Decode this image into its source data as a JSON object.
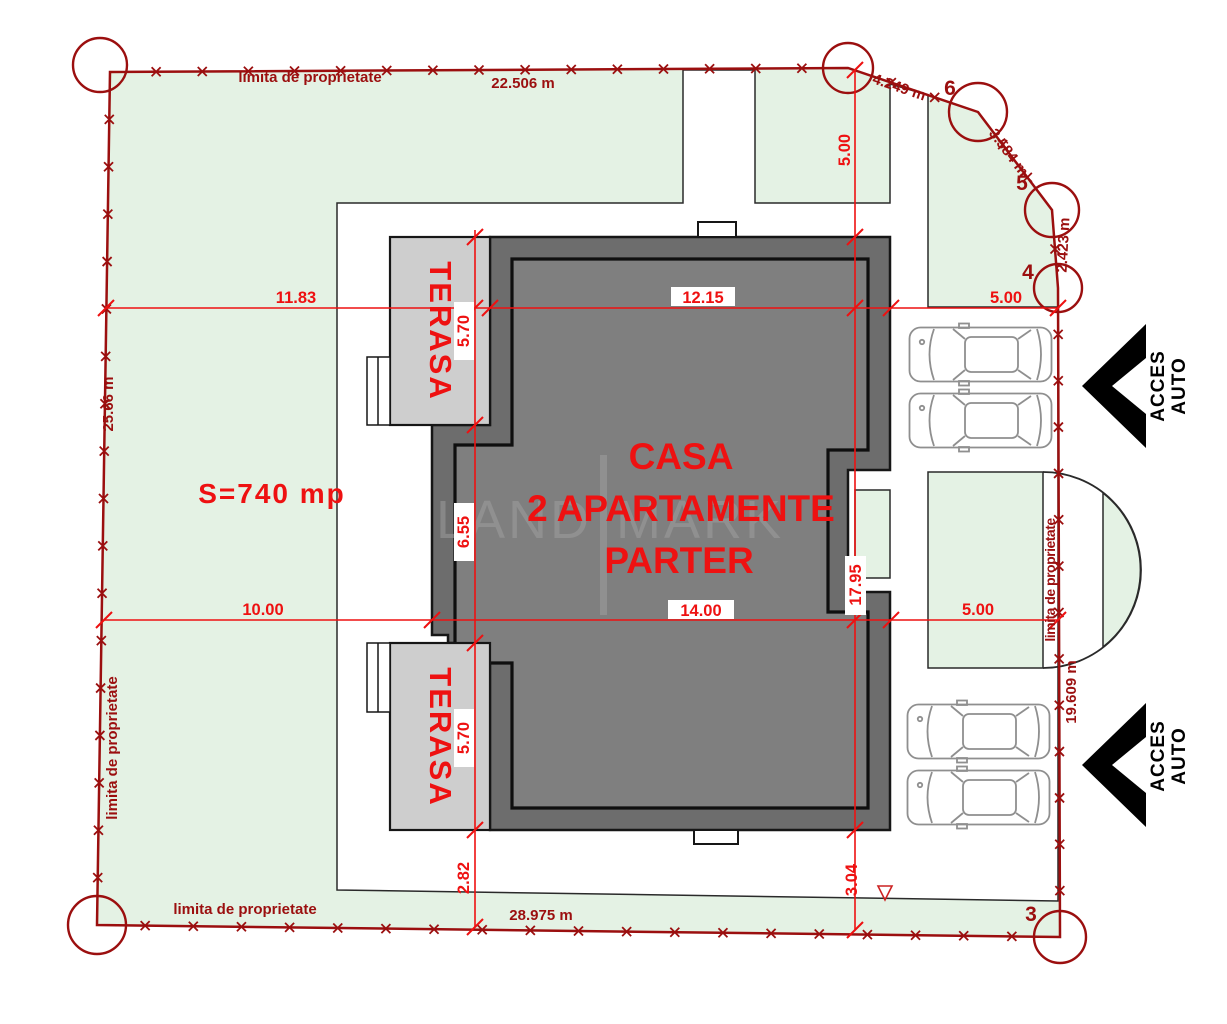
{
  "watermark": {
    "left": "LAND",
    "right": "MARK"
  },
  "area_label": "S=740 mp",
  "building_label": {
    "line1": "CASA",
    "line2": "2 APARTAMENTE",
    "line3": "PARTER"
  },
  "terraces": {
    "top": "TERASA",
    "bottom": "TERASA"
  },
  "boundary": {
    "label_top": "limita  de proprietate",
    "label_left": "limita de proprietate",
    "label_bottom": "limita de proprietate",
    "label_right": "limita de proprietate",
    "len_top": "22.506 m",
    "len_left": "25.66 m",
    "len_bottom": "28.975 m",
    "len_right": "19.609 m",
    "len_ne1": "4.249 m",
    "len_ne2": "3.584 m",
    "len_ne3": "2.423 m",
    "points": {
      "p3": "3",
      "p4": "4",
      "p5": "5",
      "p6": "6"
    }
  },
  "dimensions": {
    "w_left": "11.83",
    "w_mid": "12.15",
    "w_right": "5.00",
    "setback_top": "5.00",
    "terrace_top": "5.70",
    "mid_section": "6.55",
    "terrace_bottom": "5.70",
    "setback_bottom_left": "2.82",
    "building_height": "17.95",
    "setback_bottom_right": "3.04",
    "w2_left": "10.00",
    "w2_mid": "14.00",
    "w2_right": "5.00"
  },
  "access": {
    "line1": "ACCES",
    "line2": "AUTO"
  },
  "colors": {
    "boundary_red": "#9b0f0f",
    "dimension_red": "#ee1111",
    "property_green": "#e4f2e4",
    "wall_gray": "#6d6d6d",
    "interior_gray": "#7f7f7f",
    "terrace_gray": "#cecece"
  }
}
